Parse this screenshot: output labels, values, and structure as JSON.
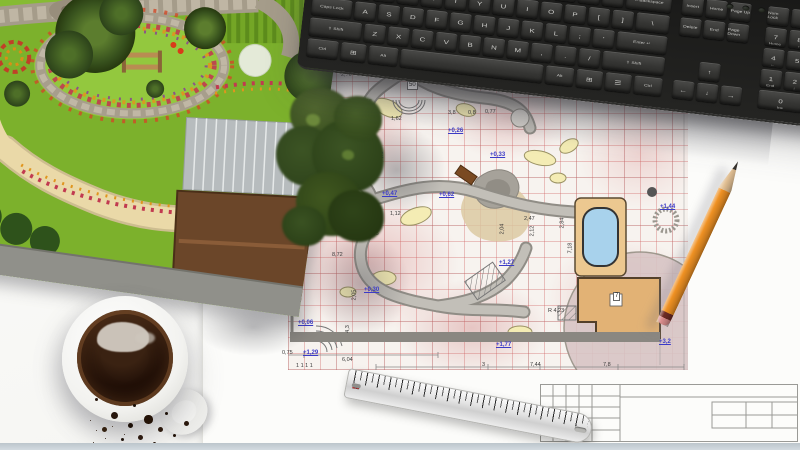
{
  "scene": {
    "objects": [
      "3d-garden-render",
      "landscape-blueprint",
      "computer-keyboard",
      "pencil",
      "metal-ruler",
      "coffee-cup"
    ]
  },
  "keyboard": {
    "led_count": 3,
    "main_rows": [
      [
        "`",
        "1",
        "2",
        "3",
        "4",
        "5",
        "6",
        "7",
        "8",
        "9",
        "0",
        "-",
        "=",
        "←Backspace"
      ],
      [
        "Tab",
        "Q",
        "W",
        "E",
        "R",
        "T",
        "Y",
        "U",
        "I",
        "O",
        "P",
        "[",
        "]",
        "\\"
      ],
      [
        "Caps Lock",
        "A",
        "S",
        "D",
        "F",
        "G",
        "H",
        "J",
        "K",
        "L",
        ";",
        "'",
        "Enter ↵"
      ],
      [
        "⇧ Shift",
        "Z",
        "X",
        "C",
        "V",
        "B",
        "N",
        "M",
        ",",
        ".",
        "/",
        "⇧ Shift"
      ],
      [
        "Ctrl",
        "⊞",
        "Alt",
        "",
        "Alt",
        "⊞",
        "☰",
        "Ctrl"
      ]
    ],
    "nav_rows": [
      [
        "Insert",
        "Home",
        "Page Up"
      ],
      [
        "Delete",
        "End",
        "Page Down"
      ]
    ],
    "arrow_keys": [
      "↑",
      "←",
      "↓",
      "→"
    ],
    "numpad_rows": [
      [
        {
          "l": "Num Lock"
        },
        {
          "l": "/"
        },
        {
          "l": "*"
        },
        {
          "l": "-"
        }
      ],
      [
        {
          "l": "7",
          "s": "Home"
        },
        {
          "l": "8",
          "s": "↑"
        },
        {
          "l": "9",
          "s": "PgUp"
        },
        {
          "l": "+"
        }
      ],
      [
        {
          "l": "4",
          "s": "←"
        },
        {
          "l": "5"
        },
        {
          "l": "6",
          "s": "→"
        },
        {
          "l": ""
        }
      ],
      [
        {
          "l": "1",
          "s": "End"
        },
        {
          "l": "2",
          "s": "↓"
        },
        {
          "l": "3",
          "s": "PgDn"
        },
        {
          "l": "Enter"
        }
      ],
      [
        {
          "l": "0",
          "s": "Ins",
          "w": 2
        },
        {
          "l": ".",
          "s": "Del"
        },
        {
          "l": ""
        }
      ]
    ]
  },
  "blueprint": {
    "levels": [
      {
        "t": "+0,02",
        "x": 80,
        "y": 82
      },
      {
        "t": "+0,26",
        "x": 160,
        "y": 58
      },
      {
        "t": "+0,33",
        "x": 202,
        "y": 82
      },
      {
        "t": "+0,47",
        "x": 94,
        "y": 121
      },
      {
        "t": "+0,62",
        "x": 151,
        "y": 122
      },
      {
        "t": "+0,30",
        "x": 76,
        "y": 217
      },
      {
        "t": "+0,06",
        "x": 10,
        "y": 250
      },
      {
        "t": "+1,27",
        "x": 211,
        "y": 190
      },
      {
        "t": "+1,44",
        "x": 372,
        "y": 134
      },
      {
        "t": "+1,77",
        "x": 208,
        "y": 272
      },
      {
        "t": "+3,2",
        "x": 371,
        "y": 269
      },
      {
        "t": "+1,29",
        "x": 15,
        "y": 280
      }
    ],
    "dims": [
      {
        "t": "rice",
        "x": 75,
        "y": 28
      },
      {
        "t": "2,70",
        "x": 53,
        "y": 2
      },
      {
        "t": "1,62",
        "x": 103,
        "y": 46
      },
      {
        "t": "3,8",
        "x": 160,
        "y": 40
      },
      {
        "t": "0,8",
        "x": 180,
        "y": 40
      },
      {
        "t": "0,77",
        "x": 197,
        "y": 39
      },
      {
        "t": "2,7",
        "x": 372,
        "y": 16,
        "r": -90
      },
      {
        "t": "3,17",
        "x": 18,
        "y": 129
      },
      {
        "t": "3,02",
        "x": 20,
        "y": 142
      },
      {
        "t": "1,12",
        "x": 102,
        "y": 141
      },
      {
        "t": "2,95",
        "x": 80,
        "y": 161
      },
      {
        "t": "8,72",
        "x": 44,
        "y": 182
      },
      {
        "t": "2,47",
        "x": 236,
        "y": 146
      },
      {
        "t": "2,04",
        "x": 209,
        "y": 156,
        "r": -90
      },
      {
        "t": "2,84",
        "x": 269,
        "y": 150,
        "r": -90
      },
      {
        "t": "7,18",
        "x": 277,
        "y": 175,
        "r": -90
      },
      {
        "t": "2,12",
        "x": 239,
        "y": 158,
        "r": -90
      },
      {
        "t": "4,3",
        "x": 56,
        "y": 256,
        "r": -90
      },
      {
        "t": "2,05",
        "x": 61,
        "y": 222,
        "r": -90
      },
      {
        "t": "R 4,23",
        "x": 260,
        "y": 238
      },
      {
        "t": "0,75",
        "x": -6,
        "y": 280
      },
      {
        "t": "6,04",
        "x": 54,
        "y": 287
      },
      {
        "t": "3",
        "x": 194,
        "y": 292
      },
      {
        "t": "7,44",
        "x": 242,
        "y": 292
      },
      {
        "t": "7,8",
        "x": 315,
        "y": 292
      },
      {
        "t": "1 1 1 1",
        "x": 8,
        "y": 293
      }
    ],
    "boxed": [
      {
        "t": "50",
        "x": 119,
        "y": 11
      },
      {
        "t": "7",
        "x": 325,
        "y": 222
      }
    ]
  },
  "ruler": {
    "numbers": [
      1,
      2,
      3,
      4,
      5,
      6,
      7,
      8,
      9,
      10,
      11,
      12,
      13,
      14,
      15,
      16,
      17,
      18,
      19,
      20
    ],
    "red_numbers": [
      10,
      20
    ]
  },
  "colors": {
    "pencil_body": "#ef9123",
    "pool_water": "#a8d2ec",
    "blueprint_level_blue": "#3b3bc8",
    "plan_grid_red": "#cd5a5a",
    "key_legend": "#cbcbc8"
  }
}
